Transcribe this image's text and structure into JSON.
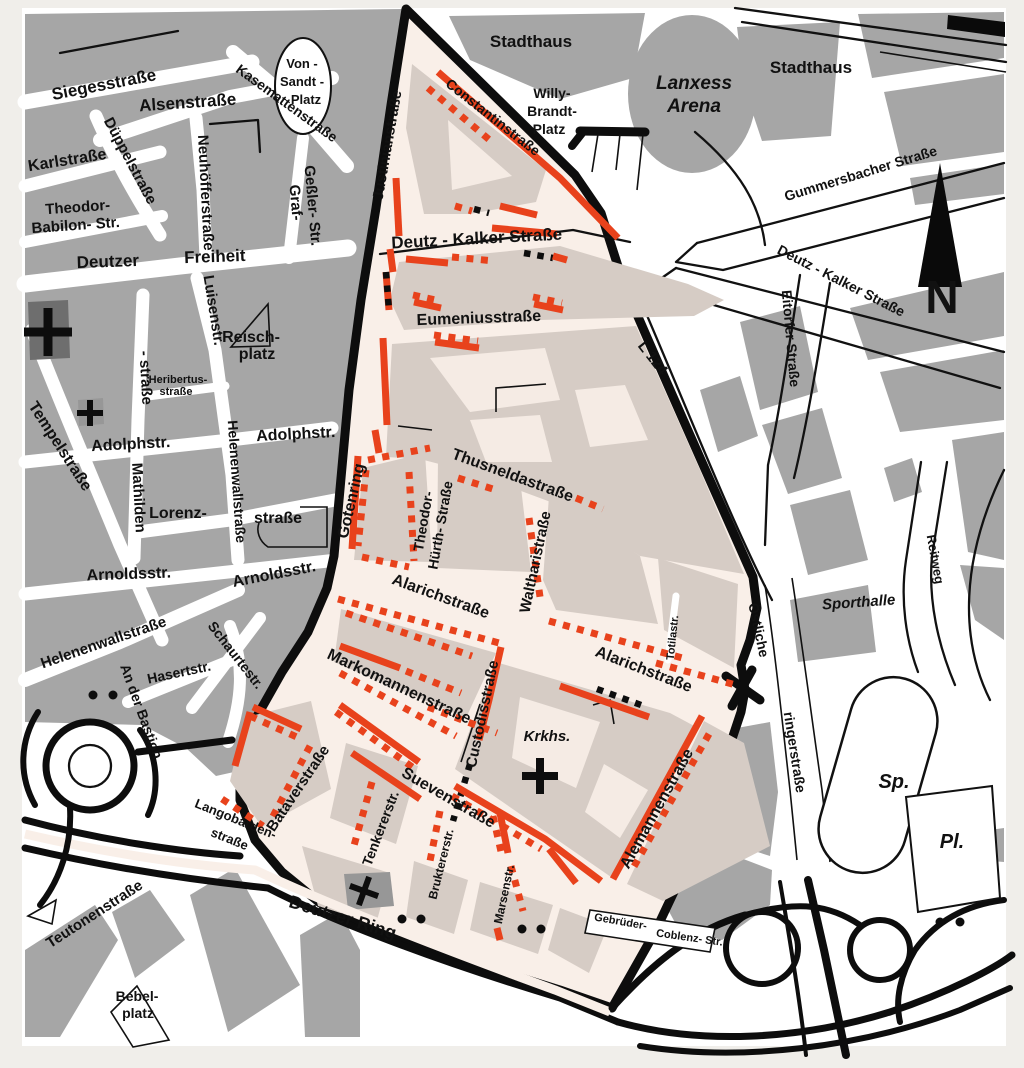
{
  "map": {
    "kind": "city-district-map",
    "colors": {
      "page": "#f0eeea",
      "outside_background": "#ffffff",
      "block_gray": "#a6a6a6",
      "church_block_gray": "#6e6e6e",
      "district_background": "#f9efe8",
      "district_block": "#d6ccc5",
      "district_courtyard": "#f5ebe4",
      "boundary_black": "#0d0d0d",
      "marking_red": "#e8421c"
    },
    "compass_label": "N",
    "labels": [
      {
        "t": "Siegesstraße",
        "x": 105,
        "y": 90,
        "r": -11,
        "s": 17
      },
      {
        "t": "Alsenstraße",
        "x": 188,
        "y": 108,
        "r": -4,
        "s": 17
      },
      {
        "t": "Kasemattenstraße",
        "x": 284,
        "y": 107,
        "r": 36,
        "s": 14
      },
      {
        "t": "Von -",
        "x": 302,
        "y": 68,
        "r": 0,
        "s": 13
      },
      {
        "t": "Sandt -",
        "x": 302,
        "y": 86,
        "r": 0,
        "s": 13
      },
      {
        "t": "Platz",
        "x": 306,
        "y": 104,
        "r": 0,
        "s": 13
      },
      {
        "t": "Düppelstraße",
        "x": 126,
        "y": 163,
        "r": 62,
        "s": 15
      },
      {
        "t": "Karlstraße",
        "x": 68,
        "y": 165,
        "r": -9,
        "s": 16
      },
      {
        "t": "Neuhöfferstraße",
        "x": 201,
        "y": 193,
        "r": 87,
        "s": 15
      },
      {
        "t": "Theodor-",
        "x": 78,
        "y": 212,
        "r": -4,
        "s": 15
      },
      {
        "t": "Babilon- Str.",
        "x": 76,
        "y": 230,
        "r": -4,
        "s": 15
      },
      {
        "t": "Deutzer",
        "x": 108,
        "y": 267,
        "r": -2,
        "s": 17
      },
      {
        "t": "Freiheit",
        "x": 215,
        "y": 262,
        "r": -2,
        "s": 17
      },
      {
        "t": "Graf-",
        "x": 291,
        "y": 203,
        "r": 85,
        "s": 15
      },
      {
        "t": "Geßler- Str.",
        "x": 308,
        "y": 206,
        "r": 85,
        "s": 15
      },
      {
        "t": "Luisenstr.",
        "x": 209,
        "y": 311,
        "r": 81,
        "s": 15
      },
      {
        "t": "Reisch-",
        "x": 251,
        "y": 342,
        "r": 0,
        "s": 16
      },
      {
        "t": "platz",
        "x": 257,
        "y": 359,
        "r": 0,
        "s": 16
      },
      {
        "t": "Heribertus-",
        "x": 178,
        "y": 383,
        "r": 0,
        "s": 11
      },
      {
        "t": "straße",
        "x": 176,
        "y": 395,
        "r": 0,
        "s": 11
      },
      {
        "t": "- straße",
        "x": 141,
        "y": 378,
        "r": 87,
        "s": 15
      },
      {
        "t": "Tempelstraße",
        "x": 56,
        "y": 449,
        "r": 57,
        "s": 16
      },
      {
        "t": "Adolphstr.",
        "x": 131,
        "y": 449,
        "r": -3,
        "s": 16
      },
      {
        "t": "Adolphstr.",
        "x": 296,
        "y": 439,
        "r": -3,
        "s": 16
      },
      {
        "t": "Helenenwallstraße",
        "x": 232,
        "y": 482,
        "r": 86,
        "s": 14
      },
      {
        "t": "Mathilden",
        "x": 134,
        "y": 498,
        "r": 87,
        "s": 15
      },
      {
        "t": "Lorenz-",
        "x": 178,
        "y": 518,
        "r": 0,
        "s": 16
      },
      {
        "t": "straße",
        "x": 278,
        "y": 523,
        "r": 0,
        "s": 16
      },
      {
        "t": "Arnoldsstr.",
        "x": 129,
        "y": 579,
        "r": -2,
        "s": 16
      },
      {
        "t": "Arnoldsstr.",
        "x": 275,
        "y": 579,
        "r": -11,
        "s": 16
      },
      {
        "t": "Helenenwallstraße",
        "x": 105,
        "y": 647,
        "r": -19,
        "s": 15
      },
      {
        "t": "An der Bastion",
        "x": 137,
        "y": 713,
        "r": 70,
        "s": 14
      },
      {
        "t": "Hasertstr.",
        "x": 180,
        "y": 677,
        "r": -12,
        "s": 14
      },
      {
        "t": "Schaurtestr.",
        "x": 232,
        "y": 658,
        "r": 52,
        "s": 14
      },
      {
        "t": "Teutonenstraße",
        "x": 97,
        "y": 918,
        "r": -33,
        "s": 15
      },
      {
        "t": "Bebel-",
        "x": 137,
        "y": 1001,
        "r": 0,
        "s": 14
      },
      {
        "t": "platz",
        "x": 138,
        "y": 1018,
        "r": 0,
        "s": 14
      },
      {
        "t": "Justinianstraße",
        "x": 392,
        "y": 146,
        "r": -80,
        "s": 15
      },
      {
        "t": "Constantinstraße",
        "x": 490,
        "y": 121,
        "r": 38,
        "s": 14
      },
      {
        "t": "Stadthaus",
        "x": 531,
        "y": 47,
        "r": 0,
        "s": 17
      },
      {
        "t": "Stadthaus",
        "x": 811,
        "y": 73,
        "r": 0,
        "s": 17
      },
      {
        "t": "Willy-",
        "x": 552,
        "y": 98,
        "r": 0,
        "s": 14
      },
      {
        "t": "Brandt-",
        "x": 552,
        "y": 116,
        "r": 0,
        "s": 14
      },
      {
        "t": "Platz",
        "x": 549,
        "y": 134,
        "r": 0,
        "s": 14
      },
      {
        "t": "Lanxess",
        "x": 694,
        "y": 89,
        "r": 0,
        "s": 19,
        "i": 1
      },
      {
        "t": "Arena",
        "x": 694,
        "y": 112,
        "r": 0,
        "s": 19,
        "i": 1
      },
      {
        "t": "Gummersbacher Straße",
        "x": 862,
        "y": 178,
        "r": -17,
        "s": 14
      },
      {
        "t": "Deutz - Kalker Straße",
        "x": 839,
        "y": 285,
        "r": 27,
        "s": 14
      },
      {
        "t": "Eitorfer Straße",
        "x": 786,
        "y": 339,
        "r": 85,
        "s": 14
      },
      {
        "t": "N",
        "x": 942,
        "y": 313,
        "r": 0,
        "s": 46
      },
      {
        "t": "Deutz - Kalker Straße",
        "x": 477,
        "y": 244,
        "r": -3,
        "s": 17
      },
      {
        "t": "Eumeniusstraße",
        "x": 479,
        "y": 323,
        "r": -2,
        "s": 16
      },
      {
        "t": "L 124",
        "x": 649,
        "y": 361,
        "r": 52,
        "s": 15
      },
      {
        "t": "Thusneldastraße",
        "x": 511,
        "y": 480,
        "r": 20,
        "s": 16
      },
      {
        "t": "Gotenring",
        "x": 356,
        "y": 502,
        "r": -77,
        "s": 16
      },
      {
        "t": "Theodor-",
        "x": 428,
        "y": 522,
        "r": -80,
        "s": 14
      },
      {
        "t": "Hürth- Straße",
        "x": 445,
        "y": 526,
        "r": -80,
        "s": 14
      },
      {
        "t": "Waltharistraße",
        "x": 540,
        "y": 563,
        "r": -78,
        "s": 15
      },
      {
        "t": "Alarichstraße",
        "x": 439,
        "y": 601,
        "r": 20,
        "s": 16
      },
      {
        "t": "Alarichstraße",
        "x": 642,
        "y": 674,
        "r": 21,
        "s": 16
      },
      {
        "t": "Totilastr.",
        "x": 676,
        "y": 638,
        "r": -84,
        "s": 11
      },
      {
        "t": "Markomannenstraße",
        "x": 397,
        "y": 691,
        "r": 25,
        "s": 16
      },
      {
        "t": "Custodisstraße",
        "x": 487,
        "y": 715,
        "r": -78,
        "s": 15
      },
      {
        "t": "Krkhs.",
        "x": 547,
        "y": 741,
        "r": 0,
        "s": 15,
        "i": 1
      },
      {
        "t": "Suevenstraße",
        "x": 446,
        "y": 802,
        "r": 30,
        "s": 16
      },
      {
        "t": "Tenkererstr.",
        "x": 385,
        "y": 830,
        "r": -69,
        "s": 14
      },
      {
        "t": "Bruktererstr.",
        "x": 445,
        "y": 865,
        "r": -76,
        "s": 12
      },
      {
        "t": "Marsenstr.",
        "x": 508,
        "y": 895,
        "r": -78,
        "s": 12
      },
      {
        "t": "Alemannenstraße",
        "x": 661,
        "y": 811,
        "r": -61,
        "s": 16
      },
      {
        "t": "Gebrüder-",
        "x": 620,
        "y": 925,
        "r": 10,
        "s": 11
      },
      {
        "t": "Coblenz- Str.",
        "x": 689,
        "y": 941,
        "r": 8,
        "s": 11
      },
      {
        "t": "Deutzer Ring",
        "x": 341,
        "y": 923,
        "r": 17,
        "s": 18
      },
      {
        "t": "Langobarden-",
        "x": 234,
        "y": 823,
        "r": 22,
        "s": 13
      },
      {
        "t": "straße",
        "x": 228,
        "y": 843,
        "r": 22,
        "s": 13
      },
      {
        "t": "Bataverstraße",
        "x": 302,
        "y": 791,
        "r": -56,
        "s": 15
      },
      {
        "t": "Sporthalle",
        "x": 859,
        "y": 607,
        "r": -4,
        "s": 15,
        "i": 1
      },
      {
        "t": "Reitweg",
        "x": 931,
        "y": 560,
        "r": 80,
        "s": 13
      },
      {
        "t": "Östliche",
        "x": 754,
        "y": 631,
        "r": 78,
        "s": 14
      },
      {
        "t": "ringerstraße",
        "x": 790,
        "y": 753,
        "r": 81,
        "s": 14
      },
      {
        "t": "Sp.",
        "x": 894,
        "y": 788,
        "r": 0,
        "s": 20,
        "i": 1
      },
      {
        "t": "Pl.",
        "x": 952,
        "y": 848,
        "r": 0,
        "s": 20,
        "i": 1
      }
    ],
    "dots": [
      {
        "x": 93,
        "y": 695
      },
      {
        "x": 113,
        "y": 695
      },
      {
        "x": 402,
        "y": 919
      },
      {
        "x": 421,
        "y": 919
      },
      {
        "x": 522,
        "y": 929
      },
      {
        "x": 541,
        "y": 929
      },
      {
        "x": 940,
        "y": 922
      },
      {
        "x": 960,
        "y": 922
      }
    ],
    "crosses": [
      {
        "x": 48,
        "y": 332,
        "a": 24,
        "w": 9,
        "r": 0,
        "name": "church-cross"
      },
      {
        "x": 90,
        "y": 413,
        "a": 13,
        "w": 6,
        "r": 0,
        "name": "church-cross"
      },
      {
        "x": 364,
        "y": 891,
        "a": 15,
        "w": 6,
        "r": 20,
        "name": "church-cross"
      },
      {
        "x": 540,
        "y": 776,
        "a": 18,
        "w": 8,
        "r": 0,
        "name": "hospital-cross"
      }
    ]
  }
}
